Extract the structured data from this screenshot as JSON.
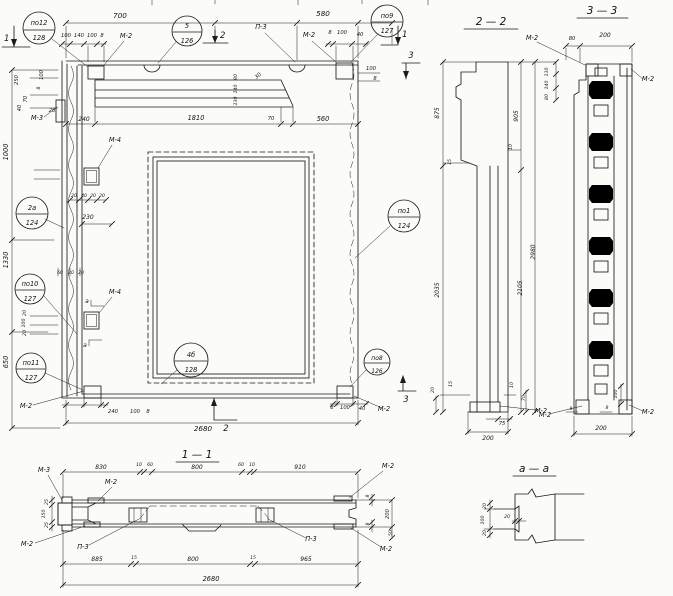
{
  "sections": {
    "s11": "1 — 1",
    "s22": "2 — 2",
    "s33": "3 — 3",
    "saa": "а — а"
  },
  "callouts": {
    "po12": {
      "num": "по12",
      "sheet": "128"
    },
    "n5": {
      "num": "5",
      "sheet": "126"
    },
    "po9": {
      "num": "по9",
      "sheet": "127"
    },
    "n2a": {
      "num": "2а",
      "sheet": "124"
    },
    "po10": {
      "num": "по10",
      "sheet": "127"
    },
    "po11": {
      "num": "по11",
      "sheet": "127"
    },
    "po1": {
      "num": "по1",
      "sheet": "124"
    },
    "po8": {
      "num": "по8",
      "sheet": "126"
    },
    "n4b": {
      "num": "4б",
      "sheet": "128"
    }
  },
  "marks": {
    "m2": "М-2",
    "m3": "М-3",
    "m4": "М-4",
    "p3": "П-3"
  },
  "cuts": {
    "c1": "1",
    "c2": "2",
    "c3": "3",
    "ca": "а"
  },
  "dims": {
    "8": "8",
    "10": "10",
    "15": "15",
    "20": "20",
    "25": "25",
    "28": "28",
    "30": "30",
    "40": "40",
    "50": "50",
    "60": "60",
    "70": "70",
    "75": "75",
    "80": "80",
    "100": "100",
    "130": "130",
    "140": "140",
    "150": "150",
    "200": "200",
    "230": "230",
    "240": "240",
    "250": "250",
    "560": "560",
    "580": "580",
    "650": "650",
    "700": "700",
    "800": "800",
    "830": "830",
    "875": "875",
    "885": "885",
    "905": "905",
    "910": "910",
    "965": "965",
    "1000": "1000",
    "1330": "1330",
    "1810": "1810",
    "2035": "2035",
    "2105": "2105",
    "2680": "2680",
    "2980": "2980"
  },
  "colors": {
    "ink": "#1b1b1b",
    "paper": "#fbfbf8"
  }
}
